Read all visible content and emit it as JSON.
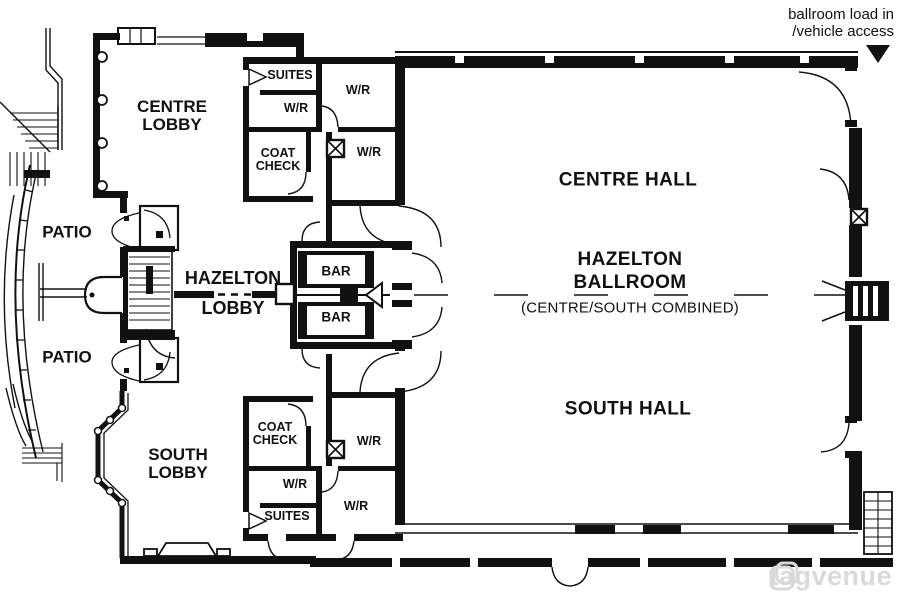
{
  "annotation": {
    "load_in_line1": "ballroom load in",
    "load_in_line2": "/vehicle access"
  },
  "halls": {
    "centre_hall": "CENTRE HALL",
    "south_hall": "SOUTH HALL",
    "ballroom_line1": "HAZELTON",
    "ballroom_line2": "BALLROOM",
    "ballroom_line3": "(CENTRE/SOUTH COMBINED)"
  },
  "lobbies": {
    "centre_line1": "CENTRE",
    "centre_line2": "LOBBY",
    "south_line1": "SOUTH",
    "south_line2": "LOBBY",
    "hazelton_line1": "HAZELTON",
    "hazelton_line2": "LOBBY"
  },
  "patios": {
    "top": "PATIO",
    "bottom": "PATIO"
  },
  "bars": {
    "top": "BAR",
    "bottom": "BAR"
  },
  "service_north": {
    "suites": "SUITES",
    "wr_inner": "W/R",
    "wr_east_upper": "W/R",
    "wr_east_lower": "W/R",
    "coat_line1": "COAT",
    "coat_line2": "CHECK"
  },
  "service_south": {
    "suites": "SUITES",
    "wr_inner": "W/R",
    "wr_east_upper": "W/R",
    "wr_east_lower": "W/R",
    "coat_line1": "COAT",
    "coat_line2": "CHECK"
  },
  "watermark": {
    "text": "tagvenue"
  },
  "colors": {
    "wall": "#111111",
    "background": "#ffffff",
    "text": "#111111",
    "watermark": "#d9d9d9"
  }
}
